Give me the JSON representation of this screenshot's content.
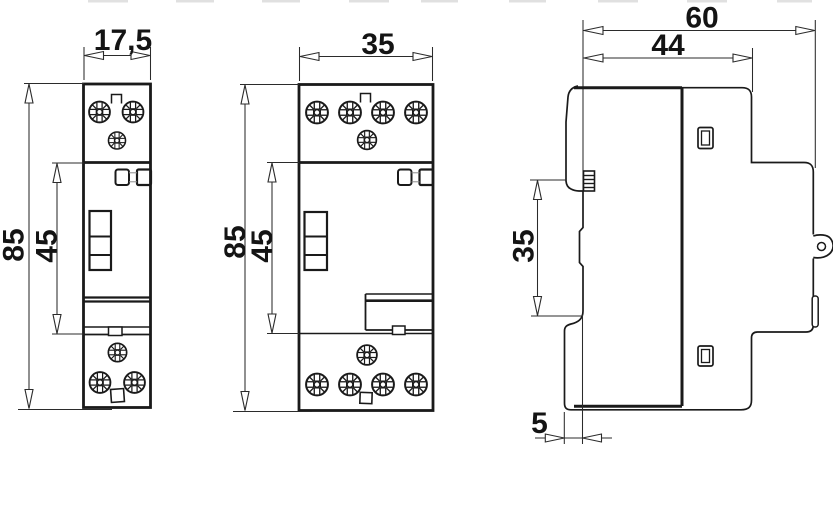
{
  "drawing": {
    "kind": "modular-contactor-dimension-drawing",
    "background_color": "#ffffff",
    "line_color": "#1a1a1a",
    "dimension_line_color": "#2b2b2b"
  },
  "views": {
    "module1": {
      "name": "front view 1-module",
      "width": "17,5",
      "height": "85",
      "switch_section": "45"
    },
    "module2": {
      "name": "front view 2-module",
      "width": "35",
      "height": "85",
      "switch_section": "45"
    },
    "side": {
      "name": "side view",
      "depth_total": "60",
      "depth_front": "44",
      "front_height": "35",
      "foot_offset": "5"
    }
  },
  "symbols": {
    "screw": "pozidriv-screw-terminal",
    "open_bracket": "terminal-marker",
    "clip": "mounting-clip",
    "lever": "switch-lever",
    "din_clip": "din-rail-release-clip"
  }
}
